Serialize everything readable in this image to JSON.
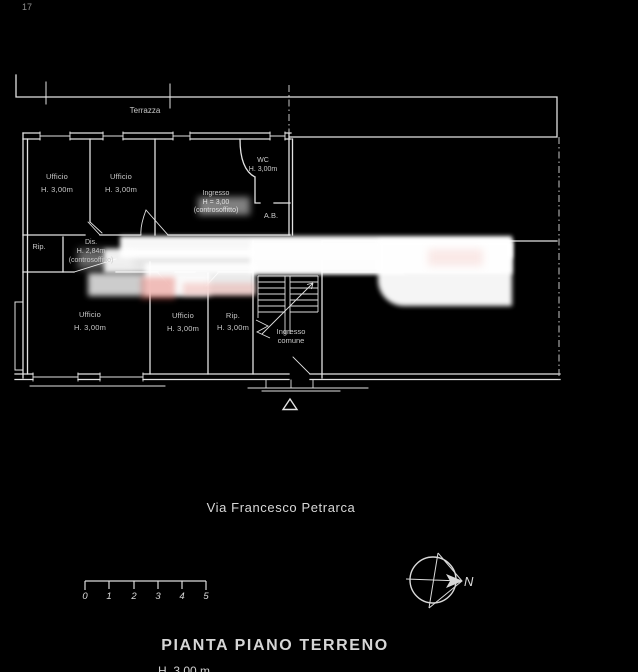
{
  "canvas": {
    "background": "#000000",
    "line_color": "#e2e2e2"
  },
  "top_left_mark": "17",
  "terrace_label": "Terrazza",
  "rooms": [
    {
      "id": "ufficio-1",
      "lines": [
        "Ufficio",
        "H. 3,00m"
      ]
    },
    {
      "id": "ufficio-2",
      "lines": [
        "Ufficio",
        "H. 3,00m"
      ]
    },
    {
      "id": "ingresso",
      "lines": [
        "Ingresso",
        "H = 3,00",
        "(controsoffitto)"
      ]
    },
    {
      "id": "wc",
      "lines": [
        "WC",
        "H. 3,00m"
      ]
    },
    {
      "id": "ab",
      "lines": [
        "A.B."
      ]
    },
    {
      "id": "rip-1",
      "lines": [
        "Rip."
      ]
    },
    {
      "id": "dis",
      "lines": [
        "Dis.",
        "H. 2,84m",
        "(controsoffitto)"
      ]
    },
    {
      "id": "ufficio-3",
      "lines": [
        "Ufficio",
        "H. 3,00m"
      ]
    },
    {
      "id": "ufficio-4",
      "lines": [
        "Ufficio",
        "H. 3,00m"
      ]
    },
    {
      "id": "rip-2",
      "lines": [
        "Rip.",
        "H. 3,00m"
      ]
    },
    {
      "id": "ingresso-comune",
      "lines": [
        "Ingresso",
        "comune"
      ]
    }
  ],
  "street_name": "Via Francesco Petrarca",
  "scale_bar": {
    "numbers": [
      "0",
      "1",
      "2",
      "3",
      "4",
      "5"
    ]
  },
  "compass": {
    "north_label": "N"
  },
  "title": "PIANTA PIANO TERRENO",
  "subtitle_cut": "H. 3,00 m",
  "watermark_color": "#f0b4aa"
}
